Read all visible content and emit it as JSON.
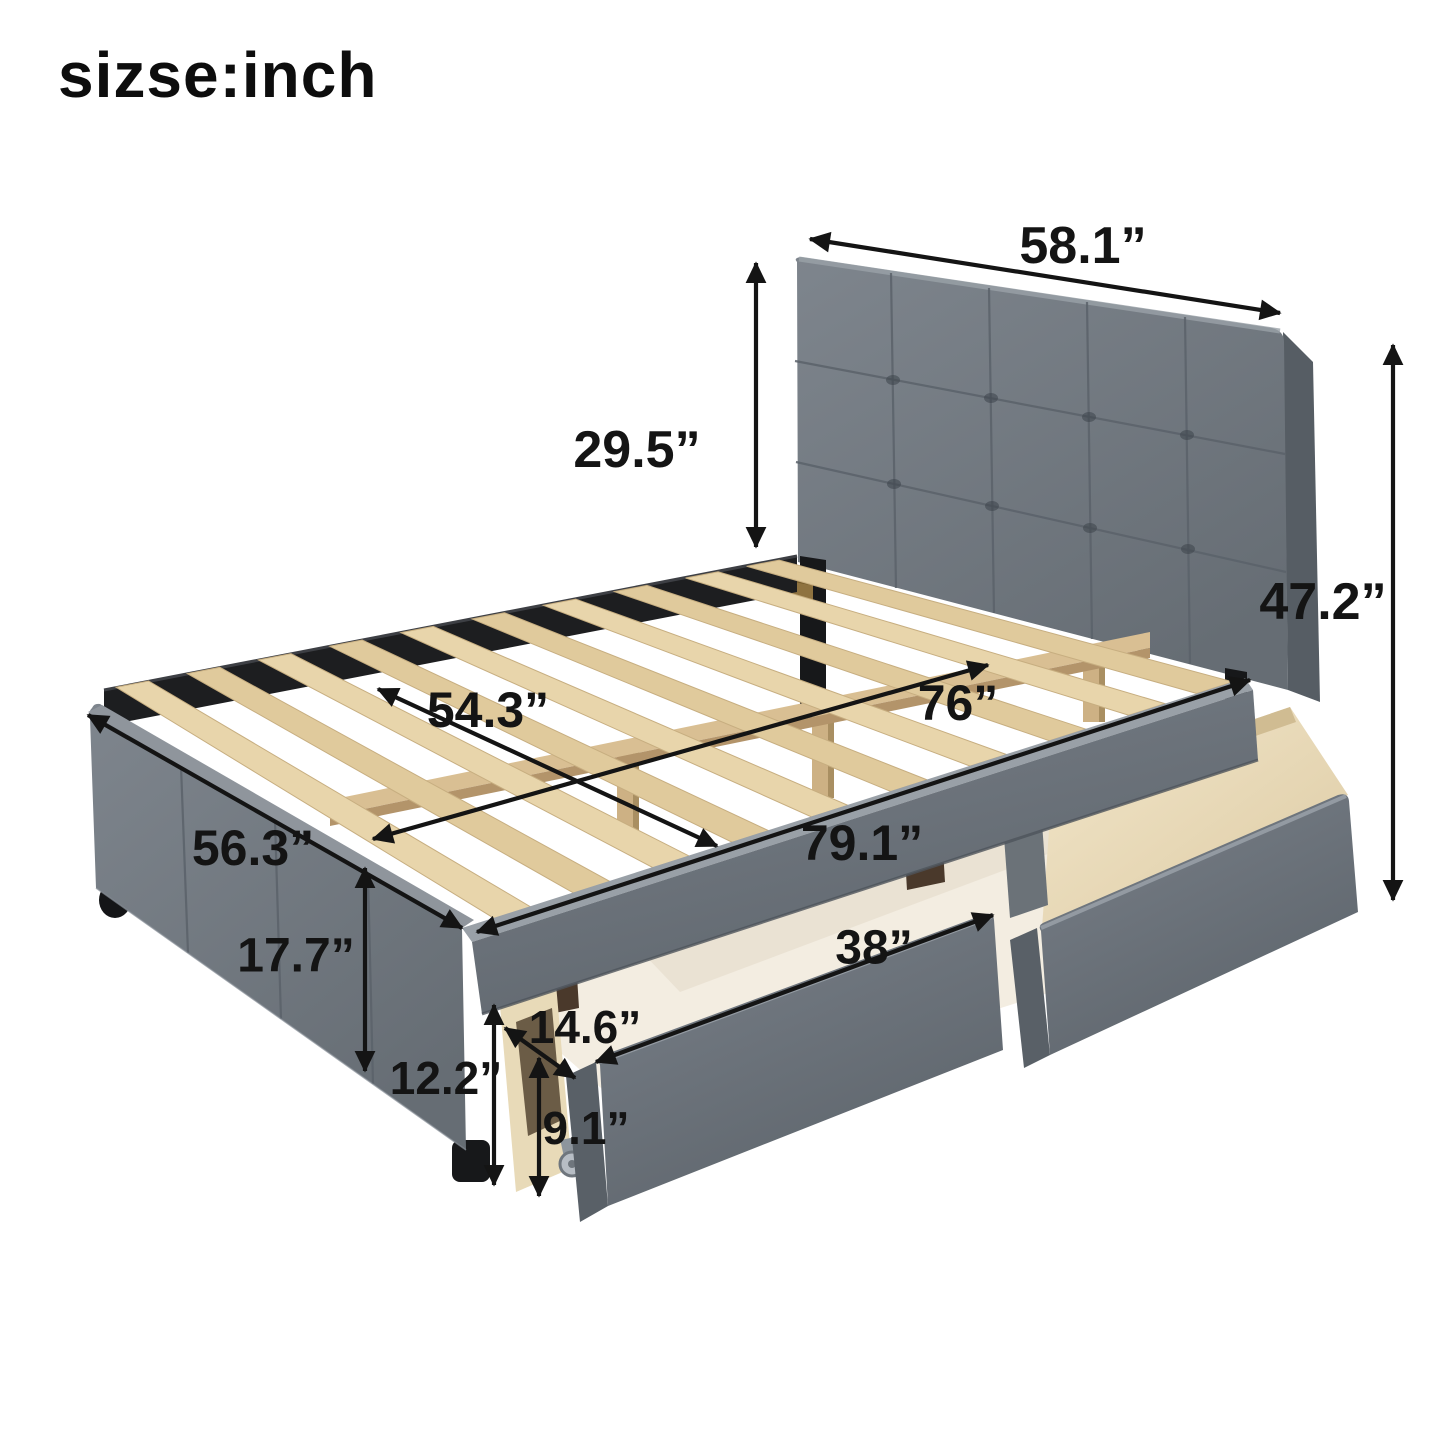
{
  "title": "sizse:inch",
  "figure": {
    "subject": "upholstered-platform-bed-with-tufted-headboard-and-two-storage-drawers",
    "unit": "inch"
  },
  "colors": {
    "background": "#ffffff",
    "arrow": "#141414",
    "fabric": "#747b83",
    "fabric_dark": "#596067",
    "fabric_light": "#99a0a7",
    "slat_wood": "#e5d1a5",
    "plywood": "#ecdfc2",
    "metal_black": "#1b1c1e",
    "slide_block_wood": "#4a392b",
    "brass_bracket": "#8f7340"
  },
  "dimensions": [
    {
      "id": "headboard-width",
      "label": "58.1”",
      "x1": 810,
      "y1": 239,
      "x2": 1280,
      "y2": 313,
      "lx": 1083,
      "ly": 246,
      "size": 52
    },
    {
      "id": "headboard-height",
      "label": "29.5”",
      "x1": 756,
      "y1": 263,
      "x2": 756,
      "y2": 547,
      "lx": 637,
      "ly": 450,
      "size": 52
    },
    {
      "id": "overall-height",
      "label": "47.2”",
      "x1": 1393,
      "y1": 345,
      "x2": 1393,
      "y2": 900,
      "lx": 1323,
      "ly": 602,
      "size": 52
    },
    {
      "id": "slat-width",
      "label": "54.3”",
      "x1": 378,
      "y1": 689,
      "x2": 717,
      "y2": 846,
      "lx": 488,
      "ly": 710,
      "size": 50
    },
    {
      "id": "interior-length",
      "label": "76”",
      "x1": 373,
      "y1": 839,
      "x2": 988,
      "y2": 665,
      "lx": 958,
      "ly": 703,
      "size": 50
    },
    {
      "id": "overall-length",
      "label": "79.1”",
      "x1": 477,
      "y1": 932,
      "x2": 1250,
      "y2": 680,
      "lx": 862,
      "ly": 843,
      "size": 50
    },
    {
      "id": "overall-width",
      "label": "56.3”",
      "x1": 88,
      "y1": 715,
      "x2": 462,
      "y2": 928,
      "lx": 253,
      "ly": 848,
      "size": 50
    },
    {
      "id": "footboard-height",
      "label": "17.7”",
      "x1": 365,
      "y1": 868,
      "x2": 365,
      "y2": 1071,
      "lx": 296,
      "ly": 956,
      "size": 48
    },
    {
      "id": "drawer-width",
      "label": "38”",
      "x1": 596,
      "y1": 1062,
      "x2": 993,
      "y2": 915,
      "lx": 874,
      "ly": 948,
      "size": 48
    },
    {
      "id": "drawer-depth",
      "label": "14.6”",
      "x1": 505,
      "y1": 1028,
      "x2": 575,
      "y2": 1078,
      "lx": 585,
      "ly": 1027,
      "size": 46
    },
    {
      "id": "base-height",
      "label": "12.2”",
      "x1": 494,
      "y1": 1005,
      "x2": 494,
      "y2": 1185,
      "lx": 446,
      "ly": 1078,
      "size": 46
    },
    {
      "id": "drawer-height",
      "label": "9.1”",
      "x1": 539,
      "y1": 1058,
      "x2": 539,
      "y2": 1196,
      "lx": 586,
      "ly": 1128,
      "size": 46
    }
  ]
}
